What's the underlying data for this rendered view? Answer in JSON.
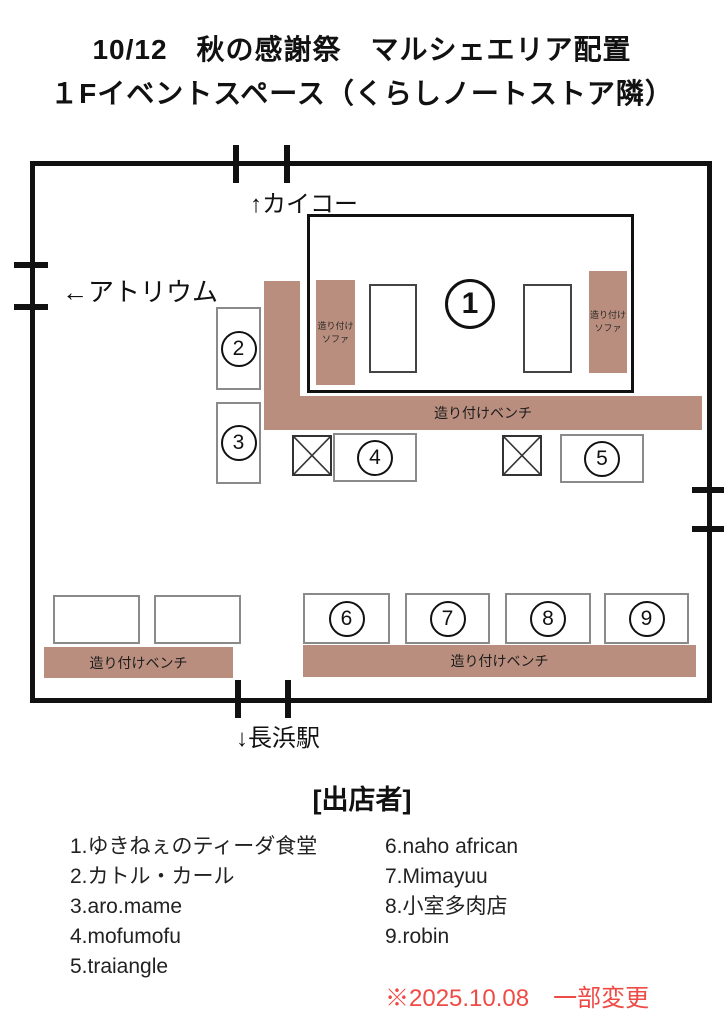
{
  "title": {
    "line1": "10/12　秋の感謝祭　マルシェエリア配置",
    "line2": "１Fイベントスペース（くらしノートストア隣）"
  },
  "map": {
    "exit_top": "↑カイコー",
    "exit_left": "←アトリウム",
    "exit_bottom": "↓長浜駅",
    "sofa_line1": "造り付け",
    "sofa_line2": "ソファ",
    "bench_label": "造り付けベンチ",
    "booths": {
      "b1": "1",
      "b2": "2",
      "b3": "3",
      "b4": "4",
      "b5": "5",
      "b6": "6",
      "b7": "7",
      "b8": "8",
      "b9": "9"
    }
  },
  "vendors": {
    "header": "[出店者]",
    "left": [
      "1.ゆきねぇのティーダ食堂",
      "2.カトル・カール",
      "3.aro.mame",
      "4.mofumofu",
      "5.traiangle"
    ],
    "right": [
      "6.naho african",
      "7.Mimayuu",
      "8.小室多肉店",
      "9.robin"
    ]
  },
  "note": "※2025.10.08　一部変更",
  "colors": {
    "bench_brown": "#b98e7e",
    "note_red": "#ee4b46",
    "wall_black": "#111111"
  }
}
